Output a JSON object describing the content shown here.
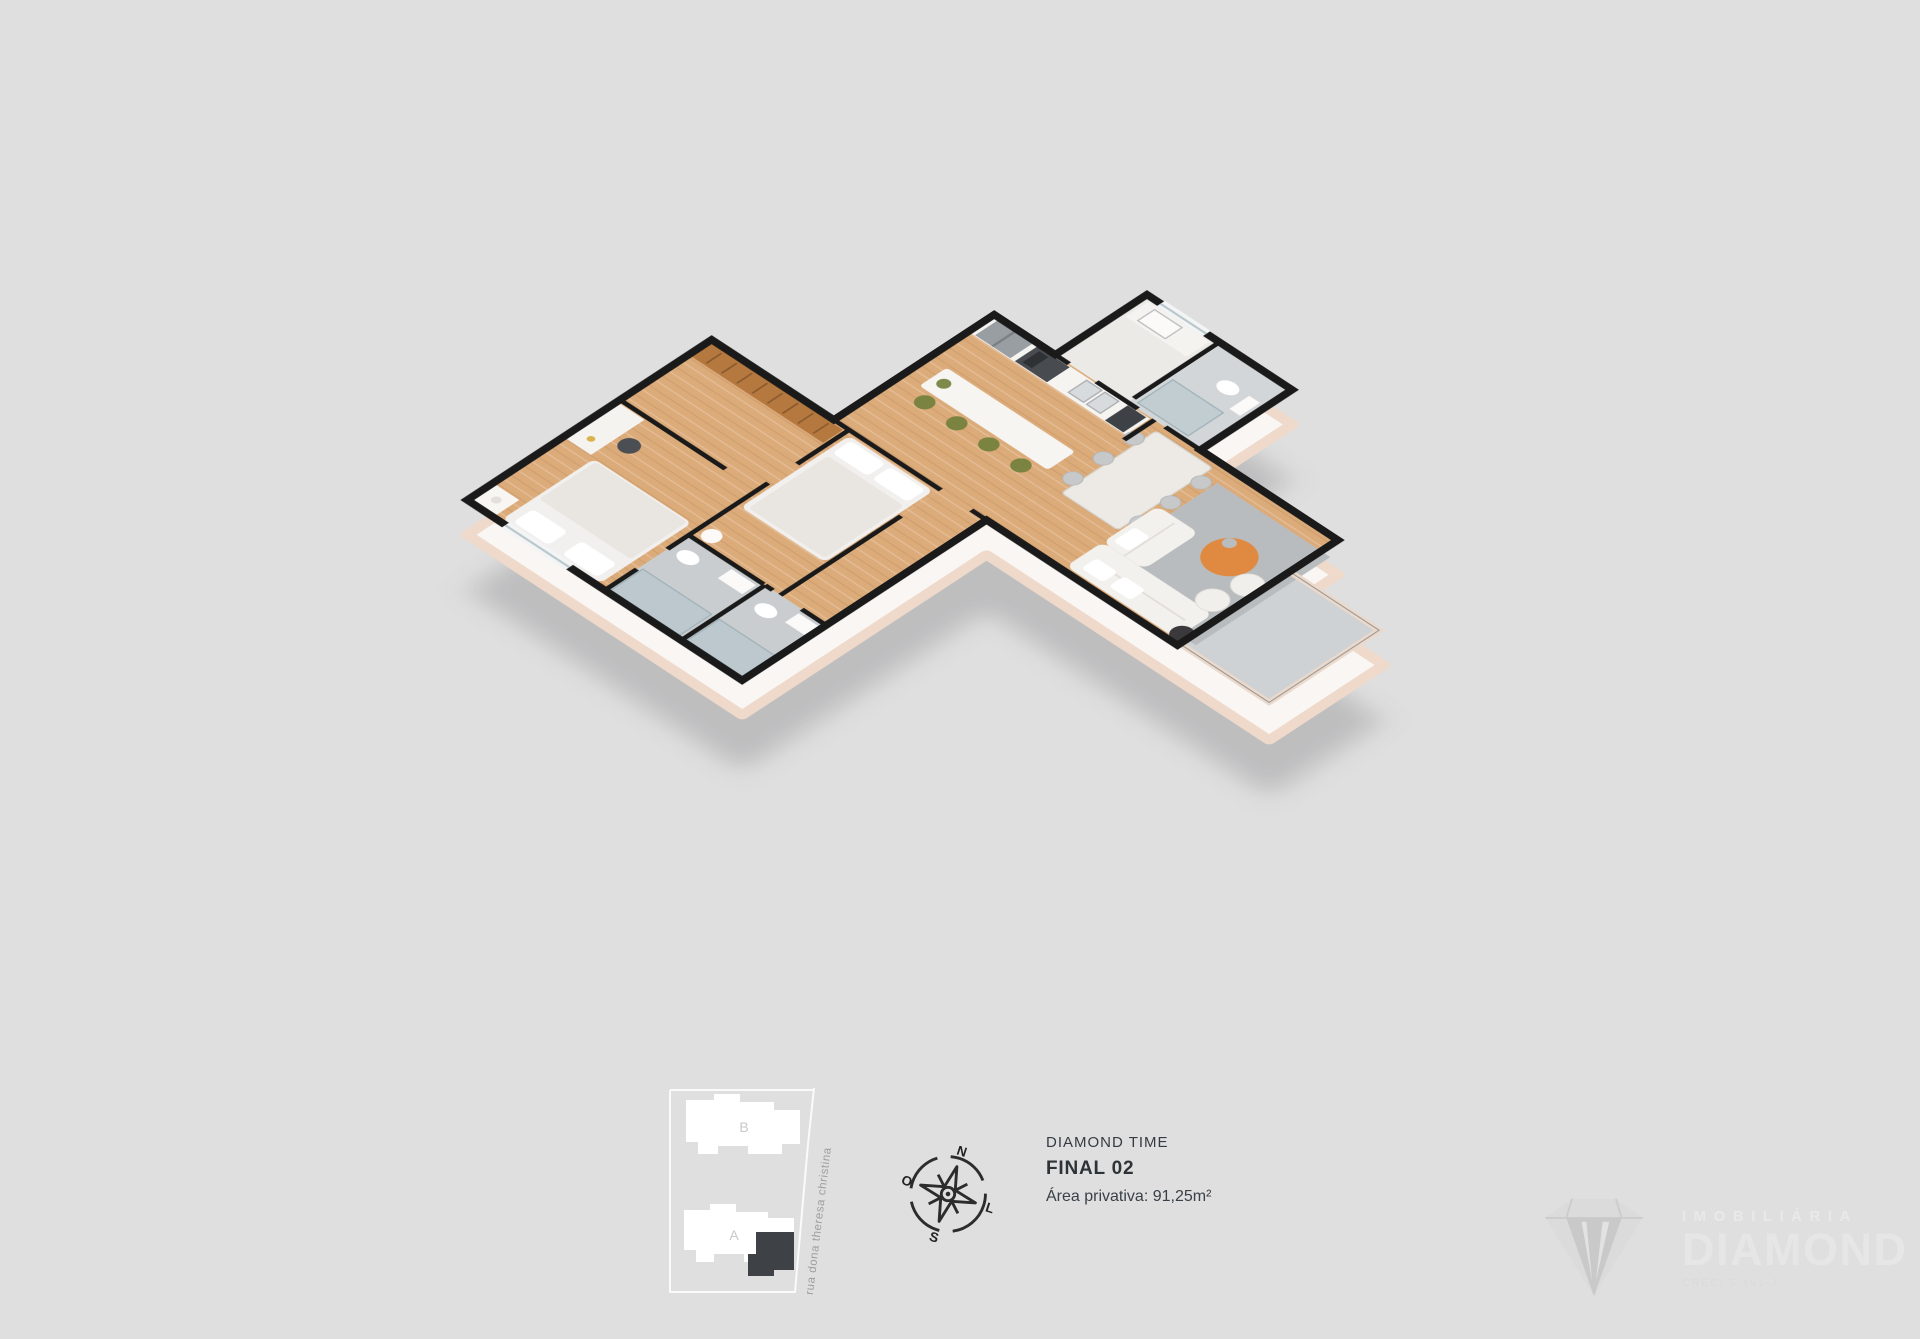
{
  "page": {
    "background": "#dfdfdf"
  },
  "unit_info": {
    "project_name": "DIAMOND TIME",
    "unit_label": "FINAL 02",
    "private_area": "Área privativa: 91,25m²"
  },
  "compass": {
    "n": "N",
    "l": "L",
    "s": "S",
    "o": "O"
  },
  "site_plan": {
    "building_a_label": "A",
    "building_b_label": "B",
    "street_label": "rua dona theresa christina",
    "highlight_color": "#3e4145"
  },
  "watermark": {
    "brand_top": "IMOBILIÁRIA",
    "brand_main": "DIAMOND",
    "brand_sub": "CRECI 5.491-J"
  },
  "floorplan": {
    "description": "3D isometric render of apartment unit Final 02",
    "rooms": [
      "bedroom-1",
      "closet-corridor",
      "ensuite-bathroom",
      "bedroom-2",
      "bathroom-2",
      "hallway",
      "kitchen",
      "laundry",
      "wc",
      "living-dining-room",
      "balcony"
    ],
    "colors": {
      "wall": "#1a1a1a",
      "wood_floor": "#dcab7a",
      "tile_floor": "#c9cdd0",
      "slab": "#f9f6f3",
      "slab_trim": "#eed9ca",
      "rug": "#b9bcbe",
      "coffee_table_accent": "#e08a41",
      "stool_green": "#7a833f",
      "marble_table": "#edeae5",
      "appliance_dark": "#484c50"
    }
  }
}
